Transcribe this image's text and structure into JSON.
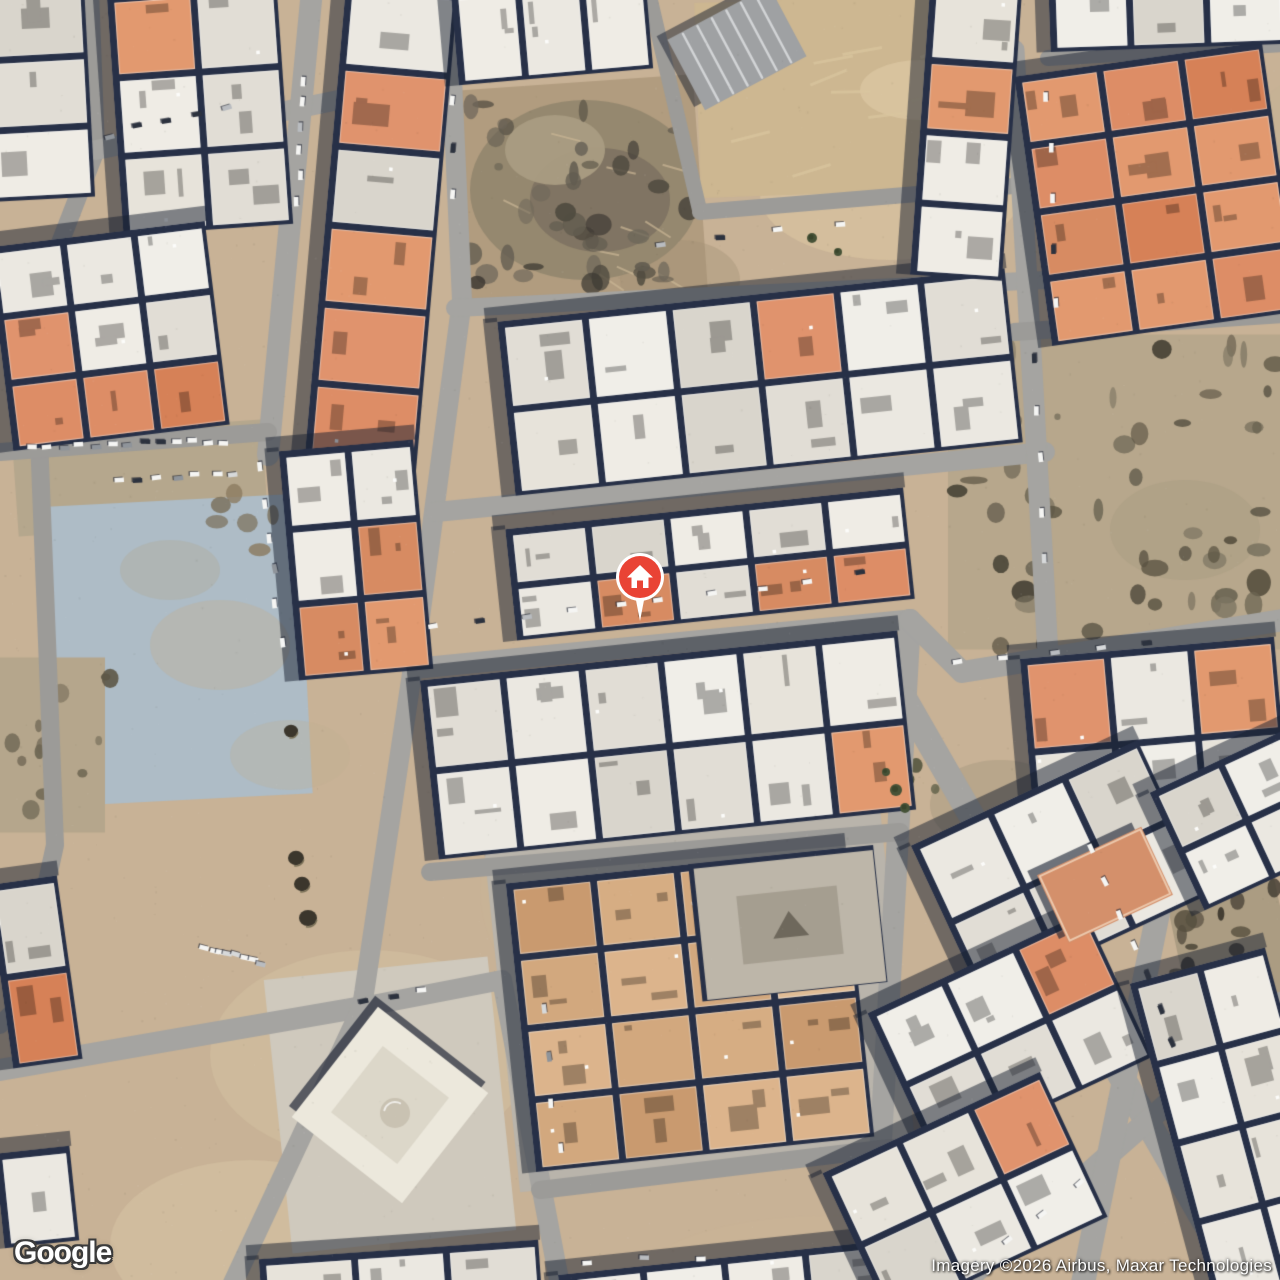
{
  "logo": {
    "label": "Google"
  },
  "attribution": {
    "label": "Imagery ©2026 Airbus, Maxar Technologies"
  },
  "marker": {
    "kind": "home-place-marker",
    "x": 640,
    "y": 577,
    "color": "#E94335",
    "ring_color": "#ffffff",
    "glyph": "house"
  },
  "map": {
    "size": 1280,
    "colors": {
      "sand": "#c8b296",
      "road": "#a5a4a1",
      "road_minor": "#9c9b98",
      "block_base": "#273047",
      "shadow_band": "rgba(24,31,48,0.5)",
      "white_roofs": [
        "#ebe8e1",
        "#e1ddd5",
        "#f0eee8",
        "#d9d5cc",
        "#e7e3da",
        "#efece5"
      ],
      "orange_roofs": [
        "#dd8d66",
        "#d68157",
        "#e0936d",
        "#d78b62",
        "#e2996f"
      ],
      "sand_roofs": [
        "#dcb48c",
        "#d2a87e",
        "#c99a6f",
        "#e0bc95",
        "#d6ad83"
      ]
    },
    "sand_patches": [
      [
        210,
        950,
        320,
        210,
        "#d4c1a1",
        0.5
      ],
      [
        110,
        1160,
        280,
        170,
        "#d8c5a5",
        0.5
      ],
      [
        640,
        1215,
        380,
        130,
        "#cab595",
        0.4
      ],
      [
        760,
        130,
        260,
        130,
        "#dfc9a4",
        0.5
      ],
      [
        60,
        330,
        140,
        180,
        "#cdbb9e",
        0.4
      ],
      [
        1240,
        80,
        120,
        200,
        "#c3b193",
        0.4
      ],
      [
        480,
        760,
        260,
        260,
        "#c9b595",
        0.4
      ],
      [
        930,
        760,
        140,
        90,
        "#a89a80",
        0.5
      ]
    ],
    "areas": [
      [
        140,
        478,
        250,
        100,
        -4,
        "#b5a78d"
      ],
      [
        180,
        650,
        250,
        300,
        -3,
        "#aebcc6"
      ],
      [
        578,
        190,
        245,
        215,
        -4,
        "#b19c7f"
      ],
      [
        855,
        95,
        315,
        195,
        -2,
        "#cdb791"
      ],
      [
        1118,
        492,
        340,
        315,
        0,
        "#b7a78c"
      ],
      [
        700,
        1000,
        398,
        345,
        -6,
        "#b9b4ab"
      ],
      [
        390,
        1105,
        225,
        275,
        -6,
        "#cfc9bd"
      ],
      [
        1232,
        945,
        110,
        240,
        -12,
        "#ab9c82"
      ],
      [
        50,
        745,
        110,
        175,
        0,
        "#b5a68c"
      ]
    ],
    "smudges": [
      [
        150,
        600,
        140,
        90,
        "#c3b08f",
        0.35
      ],
      [
        230,
        720,
        120,
        70,
        "#bfae92",
        0.3
      ],
      [
        120,
        540,
        100,
        60,
        "#b4a68c",
        0.3
      ],
      [
        620,
        240,
        120,
        80,
        "#a39276",
        0.4
      ],
      [
        860,
        60,
        120,
        60,
        "#e3d0ab",
        0.5
      ],
      [
        1110,
        480,
        150,
        100,
        "#a69a7f",
        0.4
      ]
    ],
    "mounds": [
      [
        585,
        190,
        115,
        90,
        "#93876f"
      ],
      [
        600,
        200,
        70,
        52,
        "#7e7362"
      ],
      [
        555,
        150,
        50,
        35,
        "#a99c82"
      ]
    ],
    "streaks": [
      {
        "zone": [
          705,
          15,
          1000,
          180
        ],
        "n": 16,
        "color": "#dac6a0",
        "len": 40,
        "ang": -0.2,
        "w": 3
      },
      {
        "zone": [
          480,
          110,
          680,
          280
        ],
        "n": 10,
        "color": "#cbb795",
        "len": 30,
        "ang": 0.4,
        "w": 2
      }
    ],
    "rock_zones": [
      {
        "zone": [
          955,
          345,
          1283,
          648
        ],
        "n": 52,
        "cols": [
          "#5a5342",
          "#6c6553",
          "#4a4538",
          "#7d7562"
        ],
        "rmin": 3,
        "rmax": 14
      },
      {
        "zone": [
          1175,
          850,
          1283,
          1062
        ],
        "n": 30,
        "cols": [
          "#453f33",
          "#57503f",
          "#38332a"
        ],
        "rmin": 3,
        "rmax": 12
      },
      {
        "zone": [
          0,
          665,
          118,
          828
        ],
        "n": 14,
        "cols": [
          "#5d5646",
          "#6f6754"
        ],
        "rmin": 3,
        "rmax": 10
      },
      {
        "zone": [
          470,
          100,
          692,
          288
        ],
        "n": 40,
        "cols": [
          "#504b40",
          "#625c50",
          "#3d3933",
          "#6e675a"
        ],
        "rmin": 3,
        "rmax": 13
      },
      {
        "zone": [
          885,
          752,
          968,
          802
        ],
        "n": 8,
        "cols": [
          "#4a5238",
          "#3e452f"
        ],
        "rmin": 3,
        "rmax": 8
      },
      {
        "zone": [
          210,
          455,
          330,
          570
        ],
        "n": 10,
        "cols": [
          "#8a7a5f",
          "#75684f"
        ],
        "rmin": 4,
        "rmax": 12
      }
    ],
    "pits": [
      [
        291,
        731,
        7
      ],
      [
        296,
        858,
        8
      ],
      [
        302,
        884,
        8
      ],
      [
        308,
        918,
        9
      ]
    ],
    "roads": [
      {
        "pts": [
          [
            90,
            -10
          ],
          [
            96,
            150
          ],
          [
            34,
            310
          ],
          [
            55,
            845
          ],
          [
            20,
            1005
          ],
          [
            0,
            1025
          ]
        ],
        "w": 18,
        "minor": true
      },
      {
        "pts": [
          [
            96,
            150
          ],
          [
            445,
            78
          ]
        ],
        "w": 20
      },
      {
        "pts": [
          [
            312,
            -10
          ],
          [
            268,
            455
          ]
        ],
        "w": 22
      },
      {
        "pts": [
          [
            0,
            452
          ],
          [
            268,
            432
          ]
        ],
        "w": 18,
        "minor": true
      },
      {
        "pts": [
          [
            448,
            -10
          ],
          [
            462,
            300
          ],
          [
            417,
            640
          ],
          [
            362,
            1007
          ]
        ],
        "w": 20
      },
      {
        "pts": [
          [
            648,
            -10
          ],
          [
            700,
            212
          ]
        ],
        "w": 15,
        "minor": true
      },
      {
        "pts": [
          [
            700,
            212
          ],
          [
            1014,
            186
          ]
        ],
        "w": 16,
        "minor": true
      },
      {
        "pts": [
          [
            455,
            308
          ],
          [
            1045,
            280
          ]
        ],
        "w": 18
      },
      {
        "pts": [
          [
            436,
            512
          ],
          [
            1045,
            452
          ]
        ],
        "w": 20
      },
      {
        "pts": [
          [
            420,
            668
          ],
          [
            910,
            620
          ]
        ],
        "w": 21
      },
      {
        "pts": [
          [
            910,
            620
          ],
          [
            873,
            1283
          ]
        ],
        "w": 22
      },
      {
        "pts": [
          [
            910,
            620
          ],
          [
            962,
            672
          ],
          [
            1283,
            620
          ]
        ],
        "w": 22
      },
      {
        "pts": [
          [
            905,
            700
          ],
          [
            1240,
            1283
          ]
        ],
        "w": 26
      },
      {
        "pts": [
          [
            362,
            1007
          ],
          [
            502,
            980
          ],
          [
            560,
            1285
          ]
        ],
        "w": 20
      },
      {
        "pts": [
          [
            0,
            1070
          ],
          [
            362,
            1007
          ]
        ],
        "w": 22
      },
      {
        "pts": [
          [
            430,
            872
          ],
          [
            900,
            832
          ]
        ],
        "w": 18,
        "minor": true
      },
      {
        "pts": [
          [
            540,
            1190
          ],
          [
            890,
            1148
          ]
        ],
        "w": 18,
        "minor": true
      },
      {
        "pts": [
          [
            1014,
            50
          ],
          [
            1048,
            655
          ]
        ],
        "w": 21
      },
      {
        "pts": [
          [
            1014,
            332
          ],
          [
            1283,
            314
          ]
        ],
        "w": 18,
        "minor": true
      },
      {
        "pts": [
          [
            1048,
            58
          ],
          [
            1283,
            44
          ]
        ],
        "w": 16,
        "minor": true
      },
      {
        "pts": [
          [
            963,
            1283
          ],
          [
            1283,
            1002
          ]
        ],
        "w": 22
      },
      {
        "pts": [
          [
            1190,
            755
          ],
          [
            1083,
            1283
          ]
        ],
        "w": 24
      },
      {
        "pts": [
          [
            362,
            1007
          ],
          [
            233,
            1283
          ]
        ],
        "w": 20
      }
    ],
    "blocks": [
      {
        "cx": 37,
        "cy": 92,
        "w": 105,
        "h": 215,
        "rot": -3,
        "cols": 1,
        "rows": 3,
        "pal": "white",
        "or": 0.35
      },
      {
        "cx": 200,
        "cy": 110,
        "w": 170,
        "h": 240,
        "rot": -4,
        "cols": 2,
        "rows": 3,
        "pal": "white",
        "or": 0.2
      },
      {
        "cx": 109,
        "cy": 336,
        "w": 218,
        "h": 205,
        "rot": -7,
        "cols": 3,
        "rows": 3,
        "pal": "white",
        "or": 0.3
      },
      {
        "cx": 381,
        "cy": 228,
        "w": 112,
        "h": 480,
        "rot": 5,
        "cols": 1,
        "rows": 6,
        "pal": "white",
        "or": 0.3
      },
      {
        "cx": 356,
        "cy": 560,
        "w": 135,
        "h": 230,
        "rot": -5,
        "cols": 2,
        "rows": 3,
        "pal": "white",
        "or": 0.15
      },
      {
        "cx": 35,
        "cy": 972,
        "w": 70,
        "h": 185,
        "rot": -8,
        "cols": 1,
        "rows": 2,
        "pal": "white",
        "or": 0.25
      },
      {
        "cx": 37,
        "cy": 1197,
        "w": 75,
        "h": 95,
        "rot": -6,
        "cols": 1,
        "rows": 1,
        "pal": "white",
        "or": 0.3
      },
      {
        "cx": 552,
        "cy": 31,
        "w": 195,
        "h": 92,
        "rot": -5,
        "cols": 3,
        "rows": 1,
        "pal": "white",
        "or": 0.3
      },
      {
        "cx": 760,
        "cy": 382,
        "w": 510,
        "h": 175,
        "rot": -6,
        "cols": 6,
        "rows": 2,
        "pal": "white",
        "or": 0.18
      },
      {
        "cx": 710,
        "cy": 564,
        "w": 400,
        "h": 112,
        "rot": -6,
        "cols": 5,
        "rows": 2,
        "pal": "white",
        "or": 0.08
      },
      {
        "cx": 668,
        "cy": 745,
        "w": 480,
        "h": 180,
        "rot": -6,
        "cols": 6,
        "rows": 2,
        "pal": "white",
        "or": 0.22
      },
      {
        "cx": 690,
        "cy": 1010,
        "w": 340,
        "h": 290,
        "rot": -6,
        "cols": 4,
        "rows": 4,
        "pal": "sand",
        "or": 0
      },
      {
        "cx": 725,
        "cy": 1285,
        "w": 330,
        "h": 55,
        "rot": -6,
        "cols": 4,
        "rows": 1,
        "pal": "white",
        "or": 0.15
      },
      {
        "cx": 400,
        "cy": 1272,
        "w": 280,
        "h": 45,
        "rot": -4,
        "cols": 3,
        "rows": 1,
        "pal": "white",
        "or": 0.2
      },
      {
        "cx": 1157,
        "cy": 194,
        "w": 250,
        "h": 272,
        "rot": -8,
        "cols": 3,
        "rows": 4,
        "pal": "orange",
        "or": 1
      },
      {
        "cx": 1167,
        "cy": 17,
        "w": 235,
        "h": 62,
        "rot": -2,
        "cols": 3,
        "rows": 1,
        "pal": "white",
        "or": 0.3
      },
      {
        "cx": 966,
        "cy": 133,
        "w": 92,
        "h": 290,
        "rot": 4,
        "cols": 1,
        "rows": 4,
        "pal": "white",
        "or": 0.15
      },
      {
        "cx": 1155,
        "cy": 740,
        "w": 255,
        "h": 185,
        "rot": -5,
        "cols": 3,
        "rows": 2,
        "pal": "white",
        "or": 0.15
      },
      {
        "cx": 1060,
        "cy": 870,
        "w": 250,
        "h": 170,
        "rot": -25,
        "cols": 3,
        "rows": 2,
        "pal": "white",
        "or": 0.15
      },
      {
        "cx": 1010,
        "cy": 1035,
        "w": 240,
        "h": 160,
        "rot": -25,
        "cols": 3,
        "rows": 2,
        "pal": "white",
        "or": 0.05
      },
      {
        "cx": 965,
        "cy": 1195,
        "w": 240,
        "h": 160,
        "rot": -25,
        "cols": 3,
        "rows": 2,
        "pal": "white",
        "or": 0.05
      },
      {
        "cx": 1240,
        "cy": 1125,
        "w": 140,
        "h": 330,
        "rot": -15,
        "cols": 2,
        "rows": 4,
        "pal": "white",
        "or": 0.08
      },
      {
        "cx": 1245,
        "cy": 820,
        "w": 150,
        "h": 130,
        "rot": -25,
        "cols": 2,
        "rows": 2,
        "pal": "white",
        "or": 0.1
      }
    ],
    "landmarks": {
      "shed": {
        "cx": 737,
        "cy": 48,
        "w": 115,
        "h": 80,
        "rot": -28,
        "base": "#9fa1a3",
        "stripe": "#d2d4d6"
      },
      "mosque": {
        "cx": 390,
        "cy": 1105,
        "size": 140,
        "rot": 38,
        "fill": "#ece8dc",
        "inner": "#dcd7c9",
        "dome": "#c9c2b2"
      },
      "courtyard": {
        "cx": 790,
        "cy": 925,
        "w": 180,
        "h": 132,
        "rot": -6,
        "fill": "#bdb6a9",
        "inner": "#a59e90",
        "core": "#6e685c"
      },
      "band_building": {
        "cx": 1105,
        "cy": 885,
        "w": 115,
        "h": 75,
        "rot": -25,
        "fill": "#d4906b"
      }
    },
    "cars": [
      [
        30,
        447,
        225,
        441,
        13
      ],
      [
        120,
        482,
        235,
        474,
        7
      ],
      [
        258,
        468,
        282,
        640,
        6
      ],
      [
        430,
        628,
        620,
        603,
        5
      ],
      [
        660,
        601,
        860,
        572,
        5
      ],
      [
        1033,
        360,
        1043,
        560,
        5
      ],
      [
        958,
        664,
        1150,
        642,
        5
      ],
      [
        1092,
        850,
        1173,
        1040,
        7
      ],
      [
        205,
        948,
        262,
        962,
        8
      ],
      [
        110,
        135,
        225,
        108,
        5
      ],
      [
        660,
        242,
        840,
        227,
        4
      ],
      [
        545,
        1010,
        558,
        1150,
        4
      ],
      [
        303,
        80,
        297,
        200,
        6
      ],
      [
        455,
        100,
        450,
        195,
        3
      ],
      [
        975,
        1268,
        1080,
        1185,
        4
      ],
      [
        1048,
        100,
        1054,
        300,
        5
      ],
      [
        585,
        1262,
        700,
        1258,
        3
      ],
      [
        365,
        1000,
        420,
        992,
        3
      ]
    ],
    "car_colors": {
      "white": "#f5f5f3",
      "dark": "#2c323e",
      "grays": [
        "#b9bcc0",
        "#8f949a",
        "#d7d9da"
      ]
    },
    "trees": [
      [
        812,
        238,
        5
      ],
      [
        838,
        252,
        4
      ],
      [
        896,
        790,
        6
      ],
      [
        905,
        808,
        5
      ],
      [
        886,
        772,
        4
      ]
    ]
  }
}
